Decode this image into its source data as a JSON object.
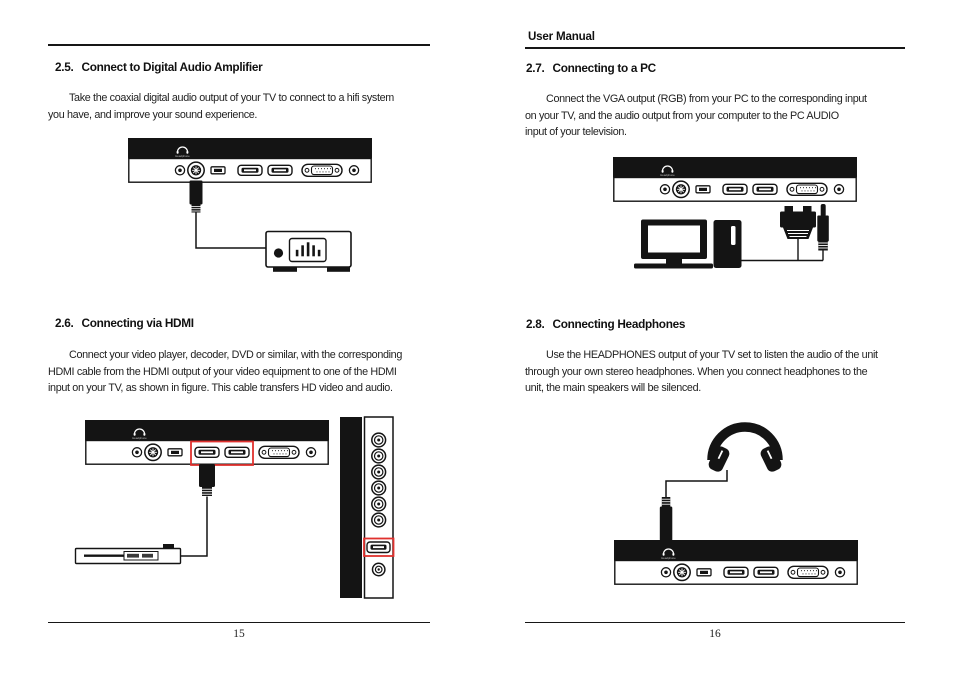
{
  "colors": {
    "ink": "#161616",
    "highlight_red": "#e0312e"
  },
  "left_page": {
    "page_number": "15",
    "sections": [
      {
        "number": "2.5.",
        "title": "Connect to Digital Audio Amplifier",
        "lines": [
          "Take the coaxial digital audio output of your TV to connect to a hifi system",
          "you have, and improve your sound experience."
        ]
      },
      {
        "number": "2.6.",
        "title": "Connecting via HDMI",
        "lines": [
          "Connect your video player, decoder, DVD or similar, with the corresponding",
          "HDMI cable from the HDMI output of your video equipment to one of the HDMI",
          "input on your TV, as shown in figure. This cable transfers HD video and audio."
        ]
      }
    ]
  },
  "right_page": {
    "header_title": "User Manual",
    "page_number": "16",
    "sections": [
      {
        "number": "2.7.",
        "title": "Connecting to a PC",
        "lines": [
          "Connect the VGA output (RGB) from your PC to the corresponding input",
          "on your TV, and the audio output from your computer to the PC AUDIO",
          "input of your television."
        ]
      },
      {
        "number": "2.8.",
        "title": "Connecting Headphones",
        "lines": [
          "Use the HEADPHONES output of your TV set to listen the audio of the unit",
          "through your own stereo headphones. When you connect headphones to the",
          "unit, the main speakers will be silenced."
        ]
      }
    ]
  },
  "figures": {
    "panel_label": "Headphone"
  }
}
